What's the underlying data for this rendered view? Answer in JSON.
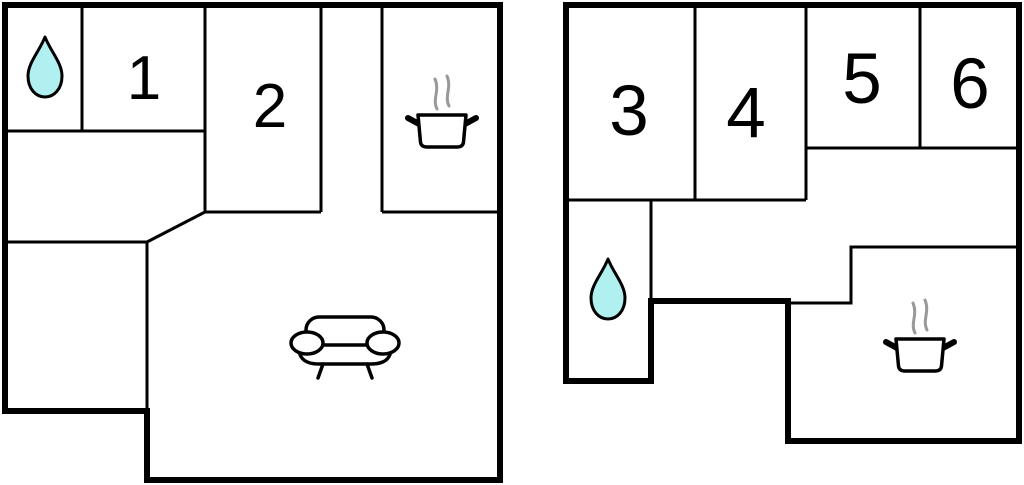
{
  "plan": {
    "type": "floor-plan",
    "background": "#ffffff",
    "colors": {
      "wall": "#000000",
      "room_fill": "#ffffff",
      "water_drop_fill": "#b0f0f0",
      "steam": "#999999",
      "label_text": "#000000"
    },
    "left_unit": {
      "rooms": [
        {
          "label": "1"
        },
        {
          "label": "2"
        }
      ],
      "icons": [
        {
          "name": "water-drop-icon",
          "meaning": "bathroom"
        },
        {
          "name": "cooking-pot-icon",
          "meaning": "kitchen"
        },
        {
          "name": "sofa-icon",
          "meaning": "living room"
        }
      ]
    },
    "right_unit": {
      "rooms": [
        {
          "label": "3"
        },
        {
          "label": "4"
        },
        {
          "label": "5"
        },
        {
          "label": "6"
        }
      ],
      "icons": [
        {
          "name": "water-drop-icon",
          "meaning": "bathroom"
        },
        {
          "name": "cooking-pot-icon",
          "meaning": "kitchen"
        }
      ]
    }
  }
}
